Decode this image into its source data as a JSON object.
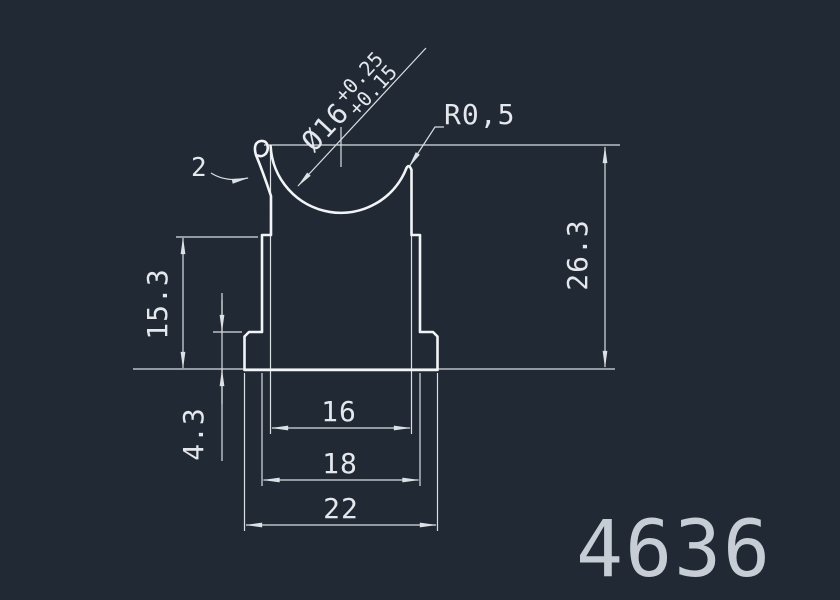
{
  "drawing": {
    "background_color": "#212934",
    "profile_line_color": "#f2f5f7",
    "dim_line_color": "#d9dee3",
    "text_color": "#e4e8ec",
    "part_number": "4636",
    "part_number_color": "#c7cdd4"
  },
  "callouts": {
    "diameter_prefix": "Ø16",
    "diameter_upper_tolerance": "+0.25",
    "diameter_lower_tolerance": "+0.15",
    "corner_radius": "R0,5",
    "lip_thickness": "2"
  },
  "dimensions": {
    "total_height": "26.3",
    "body_height": "15.3",
    "base_height": "4.3",
    "groove_width": "16",
    "body_width": "18",
    "base_width": "22"
  }
}
